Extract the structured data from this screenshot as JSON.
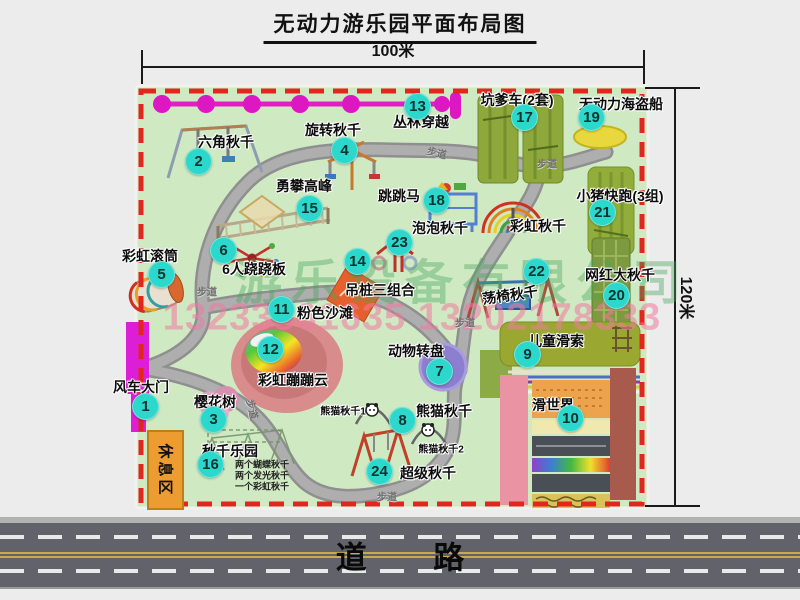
{
  "title": "无动力游乐园平面布局图",
  "dim": {
    "width": "100米",
    "height": "120米"
  },
  "watermark": {
    "company": "游乐设备有限公司",
    "phone": "13233861635 13202178333"
  },
  "road_label": "道 路",
  "rest_area_label": "休息区",
  "path_label": "步道",
  "extra_labels": {
    "rainbow_swing_mid": "彩虹秋千",
    "panda_swing_1": "熊猫秋千1",
    "panda_swing_2": "熊猫秋千2",
    "swing_park_notes": [
      "两个蝴蝶秋千",
      "两个发光秋千",
      "一个彩虹秋千"
    ]
  },
  "attractions": [
    {
      "num": 1,
      "name": "风车大门"
    },
    {
      "num": 2,
      "name": "六角秋千"
    },
    {
      "num": 3,
      "name": "樱花树"
    },
    {
      "num": 4,
      "name": "旋转秋千"
    },
    {
      "num": 5,
      "name": "彩虹滚筒"
    },
    {
      "num": 6,
      "name": "6人跷跷板"
    },
    {
      "num": 7,
      "name": "动物转盘"
    },
    {
      "num": 8,
      "name": "熊猫秋千"
    },
    {
      "num": 9,
      "name": "儿童滑索"
    },
    {
      "num": 10,
      "name": "滑世界"
    },
    {
      "num": 11,
      "name": "粉色沙滩"
    },
    {
      "num": 12,
      "name": "彩虹蹦蹦云"
    },
    {
      "num": 13,
      "name": "丛林穿越"
    },
    {
      "num": 14,
      "name": "吊桩三组合"
    },
    {
      "num": 15,
      "name": "勇攀高峰"
    },
    {
      "num": 16,
      "name": "秋千乐园"
    },
    {
      "num": 17,
      "name": "坑爹车(2套)"
    },
    {
      "num": 18,
      "name": "跳跳马"
    },
    {
      "num": 19,
      "name": "无动力海盗船"
    },
    {
      "num": 20,
      "name": "网红大秋千"
    },
    {
      "num": 21,
      "name": "小猪快跑(3组)"
    },
    {
      "num": 22,
      "name": "荡椅秋千"
    },
    {
      "num": 23,
      "name": "泡泡秋千"
    },
    {
      "num": 24,
      "name": "超级秋千"
    }
  ]
}
